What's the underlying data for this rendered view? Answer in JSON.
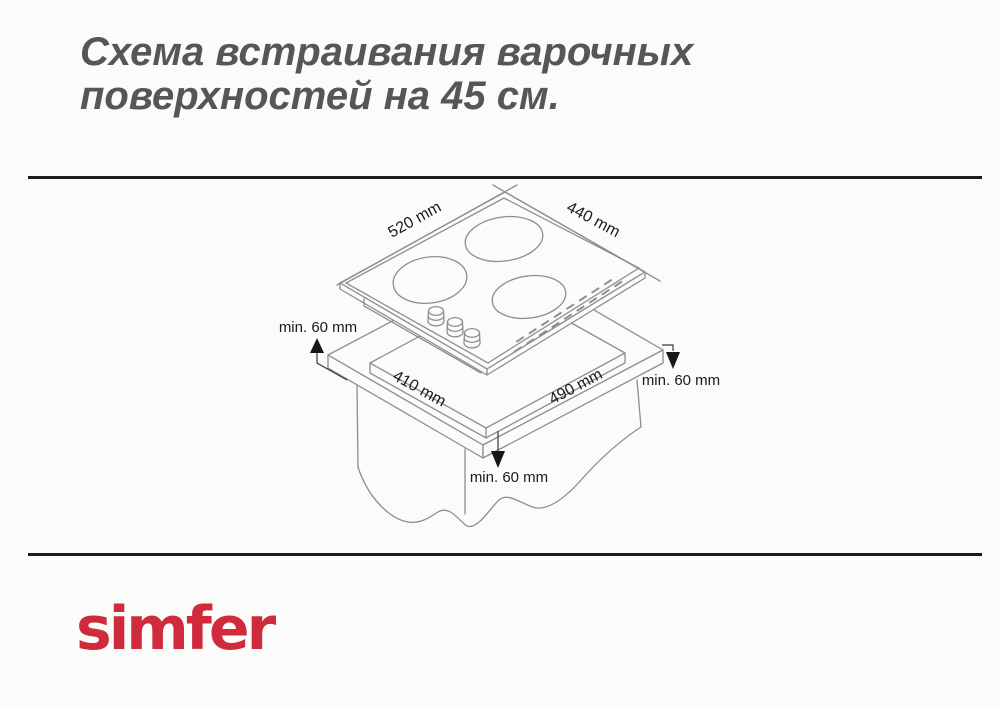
{
  "title": {
    "line1": "Схема встраивания варочных",
    "line2": "поверхностей на 45 см."
  },
  "diagram": {
    "hob_width_label": "520 mm",
    "hob_depth_label": "440 mm",
    "cutout_width_label": "410 mm",
    "cutout_depth_label": "490 mm",
    "clearance_left_label": "min. 60 mm",
    "clearance_right_label": "min. 60 mm",
    "clearance_bottom_label": "min. 60 mm"
  },
  "brand": {
    "logo_text": "simfer",
    "color": "#cf2b3c"
  },
  "colors": {
    "background": "#fbfbf9",
    "rule": "#1c1c1c",
    "drawing_line": "#8e8e8e",
    "dimension_text": "#1a1a1a",
    "title_text": "#55565a"
  }
}
